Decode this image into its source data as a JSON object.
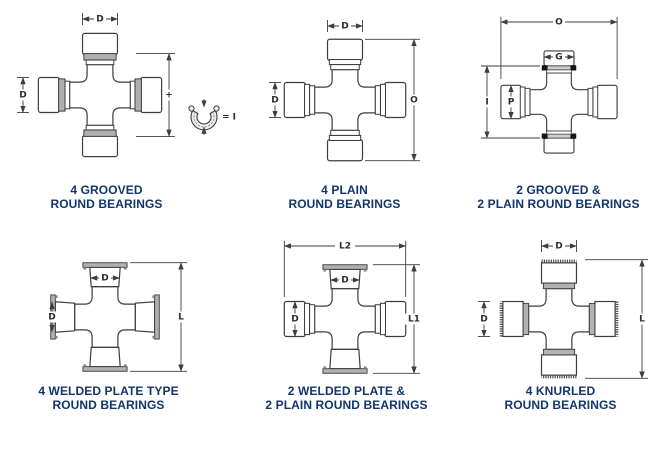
{
  "page": {
    "background": "#ffffff"
  },
  "colors": {
    "line": "#3e3e3e",
    "caption_text": "#12356b",
    "groove_gray": "#b0b0b0",
    "groove_dark": "#161616",
    "plate_gray": "#b0b0b0"
  },
  "diagrams": [
    {
      "name": "4-grooved-round-bearings",
      "caption": [
        "4 GROOVED",
        "ROUND BEARINGS"
      ],
      "dims": {
        "top": "D",
        "left": "D",
        "right": "+",
        "ring_equals": "= I"
      }
    },
    {
      "name": "4-plain-round-bearings",
      "caption": [
        "4 PLAIN",
        "ROUND BEARINGS"
      ],
      "dims": {
        "top": "D",
        "left": "D",
        "right": "O"
      }
    },
    {
      "name": "2-grooved-2-plain-round-bearings",
      "caption": [
        "2 GROOVED &",
        "2 PLAIN ROUND BEARINGS"
      ],
      "dims": {
        "overall": "O",
        "cap": "G",
        "left": "I",
        "bore": "P"
      }
    },
    {
      "name": "4-welded-plate-type-round-bearings",
      "caption": [
        "4 WELDED PLATE TYPE",
        "ROUND BEARINGS"
      ],
      "dims": {
        "top": "D",
        "left": "D",
        "right": "L"
      }
    },
    {
      "name": "2-welded-plate-2-plain-round-bearings",
      "caption": [
        "2 WELDED PLATE &",
        "2 PLAIN ROUND BEARINGS"
      ],
      "dims": {
        "overall": "L2",
        "top": "D",
        "left": "D",
        "right": "L1"
      }
    },
    {
      "name": "4-knurled-round-bearings",
      "caption": [
        "4 KNURLED",
        "ROUND BEARINGS"
      ],
      "dims": {
        "top": "D",
        "left": "D",
        "right": "L"
      }
    }
  ]
}
